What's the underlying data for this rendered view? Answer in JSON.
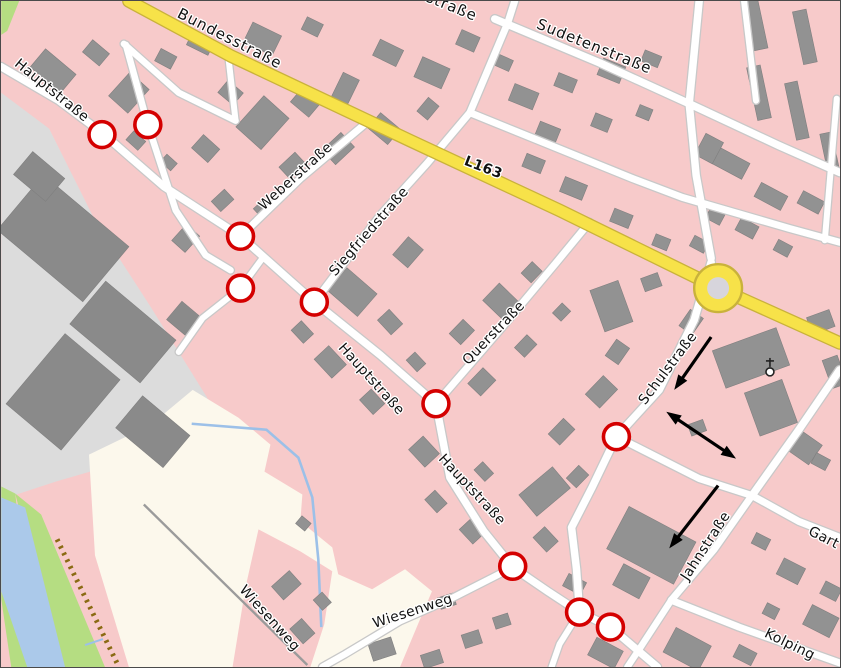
{
  "map": {
    "colors": {
      "pink": "#f7caca",
      "industrial": "#dcdcdc",
      "cream": "#fcf8ec",
      "green": "#b5dd82",
      "river": "#abc9ea",
      "stream": "#9cc0e8",
      "track": "#9b9b9b",
      "dash": "#8a6a12",
      "building": "#929292",
      "building_stroke": "#7f7f7f",
      "ind_building": "#8a8a8a",
      "road_fill": "#ffffff",
      "road_casing": "#c8c8c8",
      "yellow_fill": "#f7e249",
      "yellow_casing": "#c9b23b",
      "marker": "#d40000",
      "roundabout_inner": "#d7d5dc",
      "arrow": "#000000"
    },
    "areas": [
      {
        "name": "industrial-area",
        "color": "industrial",
        "points": "0,92 48,128 95,222 150,307 206,397 238,463 234,508 198,528 148,508 96,470 55,482 0,500"
      },
      {
        "name": "meadow-area",
        "color": "cream",
        "points": "88,455 150,425 192,390 238,418 270,445 264,472 302,495 300,522 332,548 338,575 372,590 405,570 432,592 418,625 400,668 128,668 94,556"
      },
      {
        "name": "pink-wedge",
        "color": "pink",
        "points": "258,530 300,552 332,572 324,625 310,668 232,668 245,588"
      },
      {
        "name": "green-corner",
        "color": "green",
        "points": "0,0 18,0 6,30 0,34"
      },
      {
        "name": "green-bank-left",
        "color": "green",
        "points": "0,487 14,494 34,668 10,668 0,600"
      },
      {
        "name": "green-bank-right",
        "color": "green",
        "points": "14,494 40,515 104,668 58,668"
      },
      {
        "name": "river",
        "color": "river",
        "points": "0,498 24,508 64,668 26,668 0,592"
      }
    ],
    "lines": [
      {
        "name": "embankment-dashes",
        "points": "56,540 118,668",
        "color": "dash",
        "width": 5,
        "dash": "2.5 5"
      },
      {
        "name": "track-path",
        "points": "143,505 307,666",
        "color": "track",
        "width": 2.4
      },
      {
        "name": "stream",
        "points": "191,424 266,430 298,458 312,498 318,560 321,628",
        "color": "stream",
        "width": 2.6
      },
      {
        "name": "stream-short",
        "points": "84,646 102,640",
        "color": "stream",
        "width": 2
      }
    ],
    "roads": [
      {
        "type": "y",
        "w": 11,
        "pts": "128,0 230,55 410,140 560,210 719,288 841,343"
      },
      {
        "type": "w",
        "w": 7.5,
        "pts": "0,66 58,100 102,133 163,186 240,236 314,302 380,355 436,404 450,478 484,532 513,568 548,592 580,613 611,628 658,668"
      },
      {
        "type": "w",
        "w": 6.5,
        "pts": "125,44 147,124 175,210 205,255 230,270"
      },
      {
        "type": "w",
        "w": 6.5,
        "pts": "123,43 178,92 235,120"
      },
      {
        "type": "w",
        "w": 7,
        "pts": "240,236 300,178 370,119"
      },
      {
        "type": "w",
        "w": 7,
        "pts": "314,302 380,215 427,163 470,112 508,22 515,0"
      },
      {
        "type": "w",
        "w": 7,
        "pts": "436,404 500,330 557,262 590,222"
      },
      {
        "type": "w",
        "w": 7,
        "pts": "470,112 633,178 683,197 790,228 841,242"
      },
      {
        "type": "w",
        "w": 7.5,
        "pts": "495,18 600,62 690,103 780,145 841,172"
      },
      {
        "type": "w",
        "w": 7.5,
        "pts": "700,0 690,103 697,175 712,258"
      },
      {
        "type": "w",
        "w": 7.5,
        "pts": "712,262 695,320 660,390 617,437 593,487 572,528 577,570 580,613"
      },
      {
        "type": "w",
        "w": 7,
        "pts": "617,437 700,479 753,496"
      },
      {
        "type": "w",
        "w": 7.5,
        "pts": "841,370 800,430 753,496"
      },
      {
        "type": "w",
        "w": 7,
        "pts": "753,496 800,522 841,538"
      },
      {
        "type": "w",
        "w": 7,
        "pts": "753,496 715,550 672,601"
      },
      {
        "type": "w",
        "w": 7,
        "pts": "672,601 740,628 841,664"
      },
      {
        "type": "w",
        "w": 6.5,
        "pts": "672,601 640,650 628,668"
      },
      {
        "type": "w",
        "w": 6.5,
        "pts": "513,568 450,600 400,622 345,655 322,668"
      },
      {
        "type": "w",
        "w": 6,
        "pts": "580,613 560,645 552,668"
      },
      {
        "type": "w",
        "w": 6,
        "pts": "262,258 240,288 202,318 178,352"
      },
      {
        "type": "w",
        "w": 6,
        "pts": "228,58 235,120"
      },
      {
        "type": "w",
        "w": 6,
        "pts": "745,0 757,100"
      },
      {
        "type": "w",
        "w": 6,
        "pts": "838,98 826,240"
      }
    ],
    "roundabout": {
      "cx": 719,
      "cy": 288,
      "r_outer": 24,
      "r_inner": 11
    },
    "church": {
      "x": 771,
      "y": 372
    },
    "buildings": [
      [
        52,
        70,
        40,
        24,
        40
      ],
      [
        95,
        52,
        22,
        16,
        40
      ],
      [
        128,
        92,
        26,
        32,
        42
      ],
      [
        165,
        58,
        18,
        14,
        28
      ],
      [
        200,
        42,
        24,
        16,
        26
      ],
      [
        262,
        38,
        32,
        22,
        26
      ],
      [
        312,
        26,
        18,
        14,
        26
      ],
      [
        230,
        92,
        20,
        16,
        40
      ],
      [
        262,
        122,
        34,
        42,
        42
      ],
      [
        305,
        102,
        24,
        18,
        40
      ],
      [
        345,
        88,
        18,
        28,
        26
      ],
      [
        205,
        148,
        22,
        18,
        42
      ],
      [
        292,
        165,
        22,
        16,
        -43
      ],
      [
        338,
        148,
        26,
        20,
        -43
      ],
      [
        222,
        200,
        18,
        14,
        -43
      ],
      [
        185,
        238,
        18,
        22,
        42
      ],
      [
        262,
        208,
        14,
        12,
        -43
      ],
      [
        135,
        140,
        16,
        12,
        42
      ],
      [
        168,
        162,
        14,
        10,
        42
      ],
      [
        388,
        52,
        26,
        18,
        26
      ],
      [
        432,
        72,
        30,
        22,
        24
      ],
      [
        468,
        40,
        20,
        16,
        24
      ],
      [
        504,
        62,
        16,
        12,
        24
      ],
      [
        384,
        128,
        20,
        26,
        -50
      ],
      [
        428,
        108,
        18,
        14,
        -50
      ],
      [
        524,
        96,
        26,
        18,
        22
      ],
      [
        566,
        82,
        20,
        14,
        22
      ],
      [
        612,
        70,
        24,
        18,
        22
      ],
      [
        652,
        58,
        18,
        12,
        22
      ],
      [
        548,
        132,
        22,
        16,
        22
      ],
      [
        602,
        122,
        18,
        14,
        22
      ],
      [
        645,
        112,
        14,
        12,
        22
      ],
      [
        757,
        24,
        14,
        50,
        -12
      ],
      [
        806,
        36,
        14,
        54,
        -12
      ],
      [
        760,
        92,
        14,
        54,
        -12
      ],
      [
        798,
        110,
        13,
        58,
        -12
      ],
      [
        831,
        152,
        12,
        40,
        -12
      ],
      [
        730,
        162,
        38,
        18,
        28
      ],
      [
        710,
        148,
        20,
        24,
        28
      ],
      [
        772,
        196,
        30,
        16,
        28
      ],
      [
        812,
        202,
        24,
        14,
        28
      ],
      [
        716,
        216,
        16,
        12,
        28
      ],
      [
        748,
        228,
        20,
        14,
        28
      ],
      [
        700,
        244,
        16,
        12,
        28
      ],
      [
        784,
        248,
        16,
        12,
        28
      ],
      [
        534,
        163,
        20,
        14,
        22
      ],
      [
        574,
        188,
        24,
        16,
        22
      ],
      [
        622,
        218,
        20,
        14,
        22
      ],
      [
        662,
        242,
        16,
        12,
        22
      ],
      [
        352,
        292,
        30,
        40,
        -49
      ],
      [
        408,
        252,
        24,
        20,
        -49
      ],
      [
        390,
        322,
        20,
        16,
        47
      ],
      [
        330,
        362,
        26,
        20,
        47
      ],
      [
        302,
        332,
        18,
        14,
        47
      ],
      [
        372,
        402,
        20,
        16,
        47
      ],
      [
        416,
        362,
        16,
        12,
        47
      ],
      [
        462,
        332,
        20,
        16,
        -46
      ],
      [
        502,
        302,
        24,
        30,
        -46
      ],
      [
        532,
        272,
        16,
        14,
        -46
      ],
      [
        482,
        382,
        22,
        18,
        -46
      ],
      [
        526,
        346,
        18,
        14,
        -46
      ],
      [
        562,
        312,
        14,
        12,
        -46
      ],
      [
        424,
        452,
        24,
        20,
        47
      ],
      [
        545,
        492,
        44,
        28,
        -40
      ],
      [
        484,
        472,
        16,
        12,
        47
      ],
      [
        436,
        502,
        18,
        14,
        47
      ],
      [
        472,
        532,
        20,
        16,
        47
      ],
      [
        562,
        432,
        22,
        16,
        -46
      ],
      [
        602,
        392,
        26,
        20,
        -46
      ],
      [
        578,
        477,
        18,
        14,
        -46
      ],
      [
        618,
        352,
        20,
        16,
        -55
      ],
      [
        612,
        306,
        30,
        44,
        -20
      ],
      [
        652,
        282,
        18,
        14,
        -20
      ],
      [
        752,
        358,
        68,
        40,
        -20
      ],
      [
        772,
        408,
        40,
        46,
        -20
      ],
      [
        692,
        322,
        20,
        16,
        -55
      ],
      [
        822,
        322,
        24,
        18,
        -20
      ],
      [
        836,
        372,
        16,
        30,
        -20
      ],
      [
        698,
        428,
        16,
        12,
        -20
      ],
      [
        806,
        448,
        24,
        26,
        -55
      ],
      [
        822,
        462,
        16,
        12,
        28
      ],
      [
        762,
        542,
        16,
        12,
        27
      ],
      [
        792,
        572,
        24,
        18,
        27
      ],
      [
        832,
        592,
        18,
        14,
        27
      ],
      [
        822,
        622,
        30,
        22,
        27
      ],
      [
        772,
        612,
        14,
        12,
        27
      ],
      [
        652,
        546,
        76,
        48,
        28
      ],
      [
        632,
        582,
        30,
        24,
        28
      ],
      [
        688,
        650,
        40,
        28,
        28
      ],
      [
        746,
        656,
        20,
        14,
        27
      ],
      [
        606,
        654,
        30,
        20,
        28
      ],
      [
        286,
        586,
        18,
        24,
        48
      ],
      [
        302,
        632,
        20,
        16,
        48
      ],
      [
        322,
        602,
        14,
        12,
        48
      ],
      [
        382,
        650,
        24,
        18,
        -18
      ],
      [
        432,
        660,
        20,
        14,
        -18
      ],
      [
        472,
        640,
        18,
        14,
        -18
      ],
      [
        502,
        622,
        16,
        12,
        -18
      ],
      [
        447,
        602,
        16,
        12,
        -18
      ],
      [
        303,
        524,
        12,
        10,
        40
      ],
      [
        546,
        540,
        20,
        16,
        47
      ],
      [
        575,
        585,
        20,
        14,
        28
      ]
    ],
    "industrial_buildings": [
      [
        62,
        238,
        112,
        72,
        40
      ],
      [
        122,
        332,
        92,
        56,
        40
      ],
      [
        62,
        392,
        72,
        92,
        40
      ],
      [
        152,
        432,
        62,
        42,
        40
      ],
      [
        38,
        176,
        42,
        30,
        40
      ],
      [
        185,
        320,
        30,
        24,
        40
      ]
    ],
    "labels": [
      {
        "text": "Bundesstraße",
        "x": 227,
        "y": 42,
        "rot": 27,
        "size": 15,
        "ls": 1
      },
      {
        "text": "straße",
        "x": 450,
        "y": 10,
        "rot": 22,
        "size": 15,
        "ls": 1
      },
      {
        "text": "Sudetenstraße",
        "x": 593,
        "y": 50,
        "rot": 22,
        "size": 15,
        "ls": 1
      },
      {
        "text": "L163",
        "x": 482,
        "y": 171,
        "rot": 21,
        "size": 14,
        "bold": true
      },
      {
        "text": "Hauptstraße",
        "x": 48,
        "y": 93,
        "rot": 39,
        "size": 14
      },
      {
        "text": "Weberstraße",
        "x": 298,
        "y": 179,
        "rot": -42,
        "size": 14
      },
      {
        "text": "Siegfriedstraße",
        "x": 372,
        "y": 234,
        "rot": -49,
        "size": 14
      },
      {
        "text": "Querstraße",
        "x": 497,
        "y": 336,
        "rot": -46,
        "size": 14
      },
      {
        "text": "Hauptstraße",
        "x": 368,
        "y": 382,
        "rot": 48,
        "size": 14
      },
      {
        "text": "Hauptstraße",
        "x": 469,
        "y": 493,
        "rot": 47,
        "size": 14
      },
      {
        "text": "Schulstraße",
        "x": 672,
        "y": 371,
        "rot": -53,
        "size": 14
      },
      {
        "text": "Jahnstraße",
        "x": 710,
        "y": 549,
        "rot": -57,
        "size": 14
      },
      {
        "text": "Gart",
        "x": 823,
        "y": 542,
        "rot": 27,
        "size": 14
      },
      {
        "text": "Kolping",
        "x": 789,
        "y": 649,
        "rot": 26,
        "size": 14
      },
      {
        "text": "Wiesenweg",
        "x": 266,
        "y": 622,
        "rot": 48,
        "size": 14
      },
      {
        "text": "Wiesenweg",
        "x": 414,
        "y": 616,
        "rot": -18,
        "size": 14
      }
    ],
    "markers": [
      [
        101,
        134
      ],
      [
        147,
        124
      ],
      [
        240,
        236
      ],
      [
        240,
        288
      ],
      [
        314,
        302
      ],
      [
        436,
        404
      ],
      [
        617,
        437
      ],
      [
        513,
        567
      ],
      [
        580,
        613
      ],
      [
        611,
        628
      ]
    ],
    "arrows": [
      {
        "tail": [
          712,
          337
        ],
        "tip": [
          675,
          390
        ],
        "double": false
      },
      {
        "tail": [
          667,
          412
        ],
        "tip": [
          737,
          459
        ],
        "double": true
      },
      {
        "tail": [
          719,
          486
        ],
        "tip": [
          670,
          549
        ],
        "double": false
      }
    ]
  }
}
